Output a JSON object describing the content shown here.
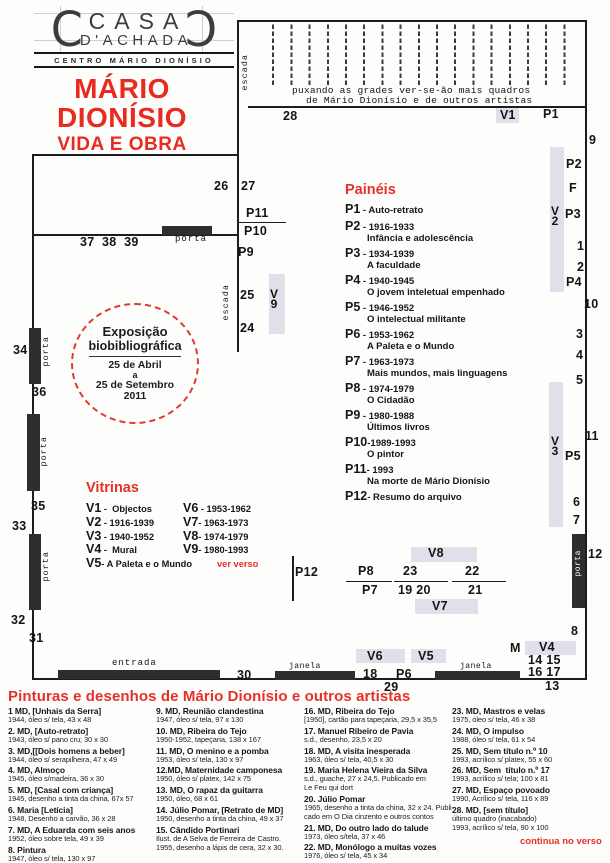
{
  "colors": {
    "accent_red": "#e92b1f",
    "heading_red": "#e5312a",
    "highlight_gray": "#e0e0ea",
    "wall_black": "#1d1d1d"
  },
  "logo": {
    "line1": "CASA",
    "line2": "D'ACHADA",
    "subtitle": "CENTRO MÁRIO DIONÍSIO"
  },
  "title": {
    "line1": "MÁRIO",
    "line2": "DIONÍSIO",
    "line3": "VIDA E OBRA"
  },
  "stamp": {
    "line1": "Exposição",
    "line2": "biobibliográfica",
    "date1": "25 de Abril",
    "date2": "a",
    "date3": "25 de Setembro",
    "year": "2011"
  },
  "plan": {
    "labels": [
      {
        "t": "escada",
        "x": 240,
        "y": 54,
        "c": "vmono"
      },
      {
        "t": "puxando as grades ver-se-ão mais quadros",
        "x": 292,
        "y": 85,
        "c": "note"
      },
      {
        "t": "de Mário Dionísio e de outros artistas",
        "x": 306,
        "y": 95,
        "c": "note"
      },
      {
        "t": "28",
        "x": 283,
        "y": 109,
        "c": "num"
      },
      {
        "t": "V1",
        "x": 496,
        "y": 108,
        "c": "vhl"
      },
      {
        "t": "P1",
        "x": 543,
        "y": 107,
        "c": "num"
      },
      {
        "t": "9",
        "x": 589,
        "y": 133,
        "c": "num"
      },
      {
        "t": "P2",
        "x": 566,
        "y": 157,
        "c": "num"
      },
      {
        "t": "F",
        "x": 569,
        "y": 181,
        "c": "num"
      },
      {
        "t": "V\n2",
        "x": 551,
        "y": 207,
        "c": "vstack"
      },
      {
        "t": "P3",
        "x": 565,
        "y": 207,
        "c": "num"
      },
      {
        "t": "1",
        "x": 577,
        "y": 239,
        "c": "num"
      },
      {
        "t": "2",
        "x": 577,
        "y": 260,
        "c": "num"
      },
      {
        "t": "P4",
        "x": 566,
        "y": 275,
        "c": "num"
      },
      {
        "t": "10",
        "x": 584,
        "y": 297,
        "c": "num"
      },
      {
        "t": "3",
        "x": 576,
        "y": 327,
        "c": "num"
      },
      {
        "t": "4",
        "x": 576,
        "y": 348,
        "c": "num"
      },
      {
        "t": "5",
        "x": 576,
        "y": 373,
        "c": "num"
      },
      {
        "t": "V\n3",
        "x": 551,
        "y": 437,
        "c": "vstack"
      },
      {
        "t": "11",
        "x": 585,
        "y": 429,
        "c": "num"
      },
      {
        "t": "P5",
        "x": 565,
        "y": 449,
        "c": "num"
      },
      {
        "t": "6",
        "x": 573,
        "y": 495,
        "c": "num"
      },
      {
        "t": "7",
        "x": 573,
        "y": 513,
        "c": "num"
      },
      {
        "t": "porta",
        "x": 574,
        "y": 550,
        "c": "vmonow"
      },
      {
        "t": "12",
        "x": 588,
        "y": 547,
        "c": "num"
      },
      {
        "t": "8",
        "x": 571,
        "y": 624,
        "c": "num"
      },
      {
        "t": "26",
        "x": 214,
        "y": 179,
        "c": "num"
      },
      {
        "t": "27",
        "x": 241,
        "y": 179,
        "c": "num"
      },
      {
        "t": "P11",
        "x": 246,
        "y": 206,
        "c": "num"
      },
      {
        "t": "P10",
        "x": 244,
        "y": 224,
        "c": "num"
      },
      {
        "t": "P9",
        "x": 238,
        "y": 245,
        "c": "num"
      },
      {
        "t": "escada",
        "x": 221,
        "y": 284,
        "c": "vmono"
      },
      {
        "t": "25",
        "x": 240,
        "y": 288,
        "c": "num"
      },
      {
        "t": "V\n9",
        "x": 270,
        "y": 290,
        "c": "vstack"
      },
      {
        "t": "24",
        "x": 240,
        "y": 321,
        "c": "num"
      },
      {
        "t": "porta",
        "x": 175,
        "y": 234,
        "c": "mono"
      },
      {
        "t": "37  38  39",
        "x": 80,
        "y": 235,
        "c": "num"
      },
      {
        "t": "34",
        "x": 13,
        "y": 343,
        "c": "num"
      },
      {
        "t": "porta",
        "x": 41,
        "y": 336,
        "c": "vmono"
      },
      {
        "t": "36",
        "x": 32,
        "y": 385,
        "c": "num"
      },
      {
        "t": "porta",
        "x": 39,
        "y": 436,
        "c": "vmono"
      },
      {
        "t": "35",
        "x": 31,
        "y": 499,
        "c": "num"
      },
      {
        "t": "33",
        "x": 12,
        "y": 519,
        "c": "num"
      },
      {
        "t": "porta",
        "x": 41,
        "y": 551,
        "c": "vmono"
      },
      {
        "t": "32",
        "x": 11,
        "y": 613,
        "c": "num"
      },
      {
        "t": "31",
        "x": 29,
        "y": 631,
        "c": "num"
      },
      {
        "t": "entrada",
        "x": 112,
        "y": 658,
        "c": "mono"
      },
      {
        "t": "30",
        "x": 237,
        "y": 668,
        "c": "num"
      },
      {
        "t": "janela",
        "x": 289,
        "y": 662,
        "c": "monosm"
      },
      {
        "t": "18",
        "x": 363,
        "y": 667,
        "c": "num"
      },
      {
        "t": "P6",
        "x": 396,
        "y": 667,
        "c": "num"
      },
      {
        "t": "29",
        "x": 384,
        "y": 680,
        "c": "num"
      },
      {
        "t": "janela",
        "x": 460,
        "y": 662,
        "c": "monosm"
      },
      {
        "t": "V6",
        "x": 367,
        "y": 649,
        "c": "num"
      },
      {
        "t": "V5",
        "x": 418,
        "y": 649,
        "c": "num"
      },
      {
        "t": "P12",
        "x": 295,
        "y": 565,
        "c": "num"
      },
      {
        "t": "P8",
        "x": 358,
        "y": 564,
        "c": "num"
      },
      {
        "t": "P7",
        "x": 362,
        "y": 583,
        "c": "num"
      },
      {
        "t": "V8",
        "x": 428,
        "y": 546,
        "c": "num"
      },
      {
        "t": "23",
        "x": 403,
        "y": 564,
        "c": "num"
      },
      {
        "t": "19 20",
        "x": 398,
        "y": 583,
        "c": "num"
      },
      {
        "t": "V7",
        "x": 432,
        "y": 599,
        "c": "num"
      },
      {
        "t": "22",
        "x": 465,
        "y": 564,
        "c": "num"
      },
      {
        "t": "21",
        "x": 468,
        "y": 583,
        "c": "num"
      },
      {
        "t": "M",
        "x": 510,
        "y": 641,
        "c": "num"
      },
      {
        "t": "V4",
        "x": 539,
        "y": 640,
        "c": "num"
      },
      {
        "t": "14 15",
        "x": 528,
        "y": 653,
        "c": "num"
      },
      {
        "t": "16 17",
        "x": 528,
        "y": 665,
        "c": "num"
      },
      {
        "t": "13",
        "x": 545,
        "y": 679,
        "c": "num"
      }
    ]
  },
  "paineis": {
    "heading": "Painéis",
    "items": [
      {
        "id": "P1",
        "rest": " -  Auto-retrato",
        "desc": null
      },
      {
        "id": "P2",
        "rest": " - 1916-1933",
        "desc": "Infância e adolescência"
      },
      {
        "id": "P3",
        "rest": " - 1934-1939",
        "desc": "A faculdade"
      },
      {
        "id": "P4",
        "rest": " - 1940-1945",
        "desc": "O jovem inteletual empenhado"
      },
      {
        "id": "P5",
        "rest": " - 1946-1952",
        "desc": "O intelectual militante"
      },
      {
        "id": "P6",
        "rest": " - 1953-1962",
        "desc": "A Paleta e o Mundo"
      },
      {
        "id": "P7",
        "rest": " - 1963-1973",
        "desc": "Mais mundos, mais linguagens"
      },
      {
        "id": "P8",
        "rest": " - 1974-1979",
        "desc": "O Cidadão"
      },
      {
        "id": "P9",
        "rest": " - 1980-1988",
        "desc": "Últimos livros"
      },
      {
        "id": "P10",
        "rest": "-1989-1993",
        "desc": "O pintor"
      },
      {
        "id": "P11",
        "rest": "- 1993",
        "desc": "Na morte de Mário Dionísio"
      },
      {
        "id": "P12",
        "rest": "- Resumo do arquivo",
        "desc": null
      }
    ]
  },
  "vitrinas": {
    "heading": "Vitrinas",
    "rows": [
      {
        "l": "V1",
        "lt": " -  Objectos",
        "r": "V6",
        "rt": " - 1953-1962",
        "red": false
      },
      {
        "l": "V2",
        "lt": " - 1916-1939",
        "r": "V7",
        "rt": "- 1963-1973",
        "red": false
      },
      {
        "l": "V3",
        "lt": " - 1940-1952",
        "r": "V8",
        "rt": "- 1974-1979",
        "red": false
      },
      {
        "l": "V4",
        "lt": " -  Mural",
        "r": "V9",
        "rt": "- 1980-1993",
        "red": false
      },
      {
        "l": "V5",
        "lt": "- A Paleta e o Mundo",
        "r": "",
        "rt": "ver verso",
        "red": true
      }
    ]
  },
  "works": {
    "heading": "Pinturas e desenhos de Mário Dionísio e outros artistas",
    "columns": [
      [
        {
          "title": "1 MD, [Unhais da Serra]",
          "details": [
            "1944, óleo s/ tela, 43 x 48"
          ]
        },
        {
          "title": "2. MD, [Auto-retrato]",
          "details": [
            "1943, óleo s/ pano cru; 30 x 30"
          ]
        },
        {
          "title": "3. MD,[[Dois homens a beber]",
          "details": [
            "1944, óleo s/ serapilheira, 47 x 49"
          ]
        },
        {
          "title": "4. MD, Almoço",
          "details": [
            "1945, óleo s/madeira, 36 x 30"
          ]
        },
        {
          "title": "5. MD, [Casal com criança]",
          "details": [
            "1945, desenho a tinta da china, 67x 57"
          ]
        },
        {
          "title": "6. Maria [Letícia]",
          "details": [
            "1948, Desenho a carvão, 36 x 28"
          ]
        },
        {
          "title": "7. MD, A Eduarda com seis anos",
          "details": [
            "1952, óleo sobre tela, 49 x 39"
          ]
        },
        {
          "title": "8. Pintura",
          "details": [
            "1947, óleo s/ tela, 130 x 97"
          ]
        }
      ],
      [
        {
          "title": "9. MD, Reunião clandestina",
          "details": [
            "1947, óleo s/ tela, 97 x 130"
          ]
        },
        {
          "title": "10. MD, Ribeira do Tejo",
          "details": [
            "1950-1952, tapeçaria, 138 x 167"
          ]
        },
        {
          "title": "11. MD, O menino e a pomba",
          "details": [
            "1953, óleo s/ tela, 130 x 97"
          ]
        },
        {
          "title": "12.MD, Maternidade camponesa",
          "details": [
            "1950, óleo s/ platex, 142 x 75"
          ]
        },
        {
          "title": "13. MD, O rapaz da guitarra",
          "details": [
            "1950, óleo, 68 x 61"
          ]
        },
        {
          "title": "14. Júlio Pomar, [Retrato de MD]",
          "details": [
            "1950, desenho a tinta da china, 49 x 37"
          ]
        },
        {
          "title": "15. Cândido Portinari",
          "details": [
            "Ilust. de A Selva de Ferreira de Castro.",
            "1955, desenho a lápis de cera, 32 x 30."
          ]
        }
      ],
      [
        {
          "title": "16. MD, Ribeira do Tejo",
          "details": [
            "[1950], cartão para tapeçaria, 29,5 x 35,5"
          ]
        },
        {
          "title": "17. Manuel Ribeiro de Pavia",
          "details": [
            "s.d., desenho, 23,5 x 20"
          ]
        },
        {
          "title": "18. MD, A visita inesperada",
          "details": [
            "1963, óleo s/ tela, 40,5 x 30"
          ]
        },
        {
          "title": "19. Maria Helena Vieira da Silva",
          "details": [
            "s.d., guache, 27 x 24,5. Publicado em",
            "Le Feu qui dort"
          ]
        },
        {
          "title": "20. Júlio Pomar",
          "details": [
            "1965, desenho a tinta da china, 32 x 24. Publi-",
            "cado em O Dia cinzento e outros contos"
          ]
        },
        {
          "title": "21. MD, Do outro lado do talude",
          "details": [
            "1973, óleo s/tela, 37 x 46"
          ]
        },
        {
          "title": "22. MD, Monólogo a muitas vozes",
          "details": [
            "1976, óleo s/ tela, 45 x 34"
          ]
        }
      ],
      [
        {
          "title": "23. MD, Mastros e velas",
          "details": [
            "1975, óleo s/ tela, 46 x 38"
          ]
        },
        {
          "title": "24. MD, O impulso",
          "details": [
            "1988, óleo s/ tela, 61 x 54"
          ]
        },
        {
          "title": "25. MD, Sem título n.º 10",
          "details": [
            "1993, acrílico s/ platex, 55 x 60"
          ]
        },
        {
          "title": "26. MD, Sem  título n.º 17",
          "details": [
            "1993, acrílico s/ tela; 100 x 81"
          ]
        },
        {
          "title": "27. MD, Espaço povoado",
          "details": [
            "1990, Acrílico s/ tela, 116 x 89"
          ]
        },
        {
          "title": "28. MD, [sem título]",
          "details": [
            "último quadro (inacabado)",
            "1993, acrílico s/ tela, 90 x 100"
          ]
        }
      ]
    ]
  },
  "footer": {
    "continua": "continua no verso"
  }
}
